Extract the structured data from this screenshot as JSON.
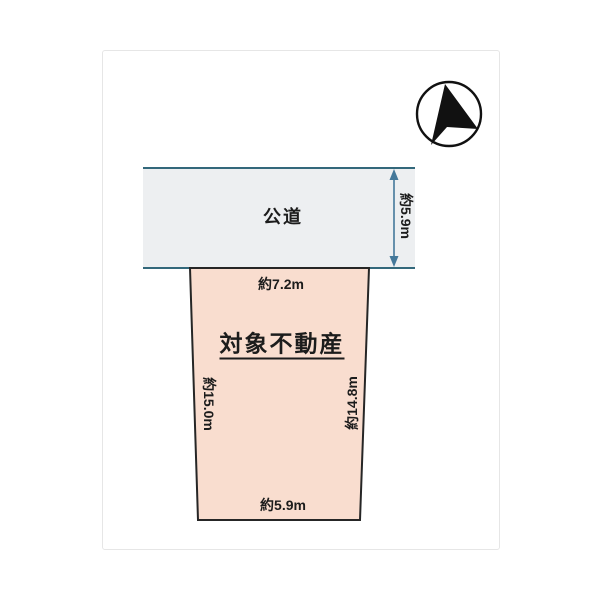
{
  "diagram": {
    "road": {
      "label": "公道",
      "width_label": "約5.9m"
    },
    "lot": {
      "label": "対象不動産",
      "top_label": "約7.2m",
      "left_label": "約15.0m",
      "right_label": "約14.8m",
      "bottom_label": "約5.9m"
    }
  },
  "colors": {
    "road_fill": "#edeff1",
    "road_edge": "#33687b",
    "dimension_arrow": "#44789a",
    "lot_fill": "#f9ddcf",
    "lot_edge": "#262626",
    "text": "#1c1c1c",
    "compass_fill": "#111111",
    "card_border": "#e6e6e6"
  }
}
